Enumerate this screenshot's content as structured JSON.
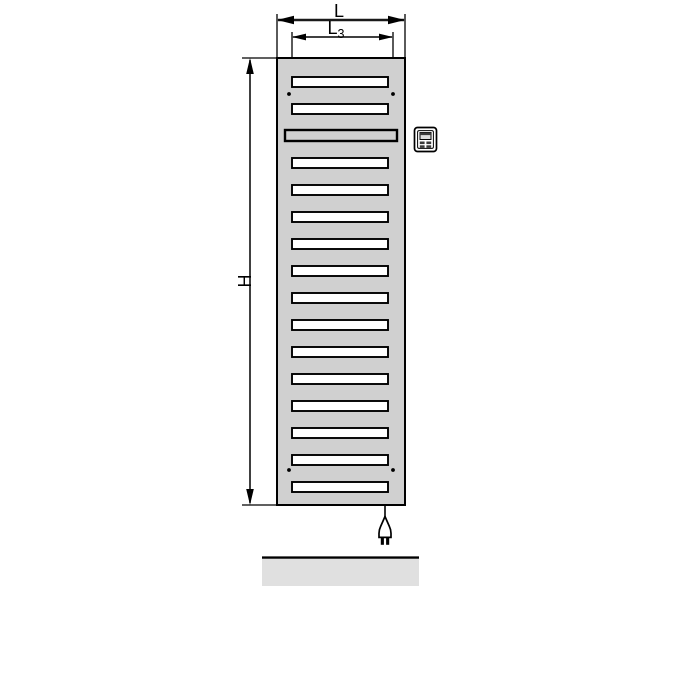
{
  "diagram": {
    "title": "electric-radiator-dimension-drawing",
    "dimension_labels": {
      "overall_width": "L",
      "slot_width_base": "L",
      "slot_width_sub": "3",
      "height": "H"
    },
    "colors": {
      "body_fill": "#d0d0d0",
      "slot_fill": "#ffffff",
      "line": "#000000",
      "floor_fill": "#e0e0e0",
      "icon_dark": "#3a3a3a",
      "icon_display": "#dcdcdc"
    },
    "radiator": {
      "slot_count": 16,
      "wide_slot_position": 3,
      "mount_dot_count": 4
    },
    "geometry": {
      "body": {
        "x": 277,
        "y": 58,
        "width": 128,
        "height": 447
      },
      "slots": {
        "count": 16,
        "x": 292,
        "width": 96,
        "height": 10,
        "first_y": 77,
        "spacing": 27,
        "wide_index": 2,
        "wide_x": 285,
        "wide_width": 112,
        "wide_height": 11
      },
      "mount_dots": [
        [
          289,
          94
        ],
        [
          393,
          94
        ],
        [
          289,
          470
        ],
        [
          393,
          470
        ]
      ],
      "floor": {
        "x": 262,
        "y": 559,
        "width": 157,
        "height": 27
      }
    },
    "icons": {
      "control_unit": "control-unit-icon",
      "power_plug": "power-plug-icon"
    }
  }
}
